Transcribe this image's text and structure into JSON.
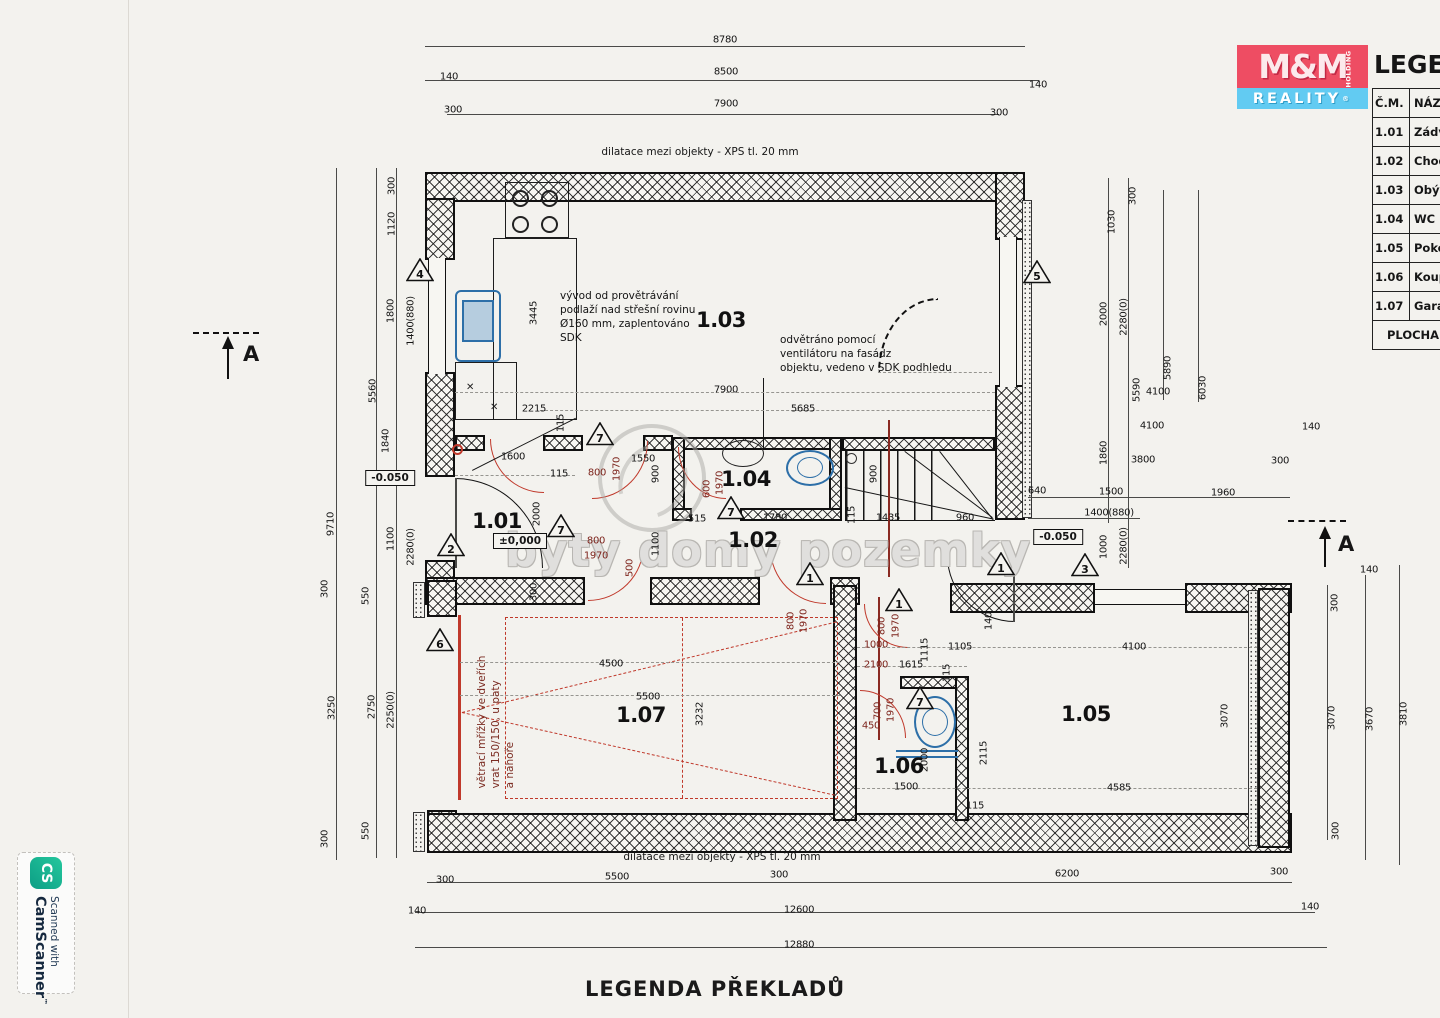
{
  "colors": {
    "accent_red": "#c0392b",
    "fixture_blue": "#2d6fa8",
    "brand_red": "#ee4d63",
    "brand_blue": "#62cbf2",
    "paper": "#f3f2ee"
  },
  "brand": {
    "mm": "M&M",
    "holding": "HOLDING",
    "reality": "REALITY",
    "reg": "®"
  },
  "legend": {
    "title": "LEGENDA",
    "col1": "Č.M.",
    "col2": "NÁZEV",
    "footer": "PLOCHA",
    "rows": [
      [
        "1.01",
        "Zádveří"
      ],
      [
        "1.02",
        "Chodba"
      ],
      [
        "1.03",
        "Obývací"
      ],
      [
        "1.04",
        "WC"
      ],
      [
        "1.05",
        "Pokoj"
      ],
      [
        "1.06",
        "Koupelna"
      ],
      [
        "1.07",
        "Garáž"
      ]
    ]
  },
  "camscanner": {
    "logo": "CS",
    "line1": "Scanned with",
    "line2": "CamScanner",
    "tm": "™"
  },
  "watermark": {
    "text": "byty domy pozemky"
  },
  "bottom_title": "LEGENDA PŘEKLADŮ",
  "top_note": "dilatace mezi objekty - XPS tl. 20 mm",
  "bottom_note": "dilatace mezi objekty - XPS tl. 20 mm",
  "section_markers": [
    {
      "label": "A"
    },
    {
      "label": "A"
    }
  ],
  "notes": [
    {
      "id": "note-vent-roof",
      "x": 560,
      "y": 290,
      "rot": 0,
      "color": "#131313",
      "lines": [
        "vývod od provětrávání",
        "podlaží nad střešní rovinu",
        "Ø160 mm, zaplentováno",
        "SDK"
      ]
    },
    {
      "id": "note-vent-fan",
      "x": 780,
      "y": 334,
      "rot": 0,
      "color": "#131313",
      "lines": [
        "odvětráno pomocí",
        "ventilátoru na fasádz",
        "objektu, vedeno v SDK podhledu"
      ]
    },
    {
      "id": "note-garage-grille",
      "x": 497,
      "y": 722,
      "rot": 1,
      "color": "#7a2a20",
      "lines": [
        "větrací mřížky ve dveřích",
        "vrat 150/150, u paty",
        "a nahoře"
      ]
    }
  ],
  "rooms": [
    [
      "1.01",
      497,
      521
    ],
    [
      "1.02",
      753,
      540
    ],
    [
      "1.03",
      721,
      320
    ],
    [
      "1.04",
      746,
      479
    ],
    [
      "1.05",
      1086,
      714
    ],
    [
      "1.06",
      899,
      766
    ],
    [
      "1.07",
      641,
      715
    ]
  ],
  "elevations": [
    [
      "±0,000",
      520,
      541
    ],
    [
      "-0.050",
      390,
      478
    ],
    [
      "-0.050",
      1058,
      537
    ]
  ],
  "triangles": [
    [
      4,
      420,
      272
    ],
    [
      5,
      1037,
      274
    ],
    [
      2,
      451,
      547
    ],
    [
      7,
      600,
      436
    ],
    [
      7,
      561,
      528
    ],
    [
      7,
      731,
      510
    ],
    [
      1,
      810,
      576
    ],
    [
      1,
      899,
      602
    ],
    [
      1,
      1001,
      566
    ],
    [
      3,
      1085,
      567
    ],
    [
      7,
      920,
      700
    ],
    [
      6,
      440,
      642
    ]
  ],
  "dims": [
    [
      "8780",
      725,
      40
    ],
    [
      "140",
      449,
      77
    ],
    [
      "8500",
      726,
      72
    ],
    [
      "140",
      1038,
      85
    ],
    [
      "300",
      453,
      110
    ],
    [
      "7900",
      726,
      104
    ],
    [
      "300",
      999,
      113
    ],
    [
      "9710",
      331,
      524,
      1
    ],
    [
      "5560",
      373,
      391,
      1
    ],
    [
      "300",
      392,
      186,
      1
    ],
    [
      "1120",
      392,
      224,
      1
    ],
    [
      "1800",
      391,
      311,
      1
    ],
    [
      "1400(880)",
      411,
      321,
      1
    ],
    [
      "1840",
      386,
      441,
      1
    ],
    [
      "1100",
      391,
      539,
      1
    ],
    [
      "2280(0)",
      411,
      547,
      1
    ],
    [
      "300",
      325,
      589,
      1
    ],
    [
      "550",
      366,
      596,
      1
    ],
    [
      "3250",
      332,
      708,
      1
    ],
    [
      "2750",
      372,
      707,
      1
    ],
    [
      "2250(0)",
      391,
      710,
      1
    ],
    [
      "550",
      366,
      831,
      1
    ],
    [
      "300",
      325,
      839,
      1
    ],
    [
      "140",
      417,
      911
    ],
    [
      "300",
      1133,
      196,
      1
    ],
    [
      "1030",
      1112,
      222,
      1
    ],
    [
      "2000",
      1104,
      314,
      1
    ],
    [
      "2280(0)",
      1124,
      317,
      1
    ],
    [
      "5590",
      1137,
      390,
      1
    ],
    [
      "5890",
      1168,
      368,
      1
    ],
    [
      "6030",
      1203,
      388,
      1
    ],
    [
      "4100",
      1158,
      392
    ],
    [
      "1860",
      1104,
      453,
      1
    ],
    [
      "4100",
      1152,
      426
    ],
    [
      "3800",
      1143,
      460
    ],
    [
      "140",
      1311,
      427
    ],
    [
      "300",
      1280,
      461
    ],
    [
      "640",
      1037,
      491
    ],
    [
      "1500",
      1111,
      492
    ],
    [
      "1960",
      1223,
      493
    ],
    [
      "1400(880)",
      1109,
      513
    ],
    [
      "1000",
      1104,
      547,
      1
    ],
    [
      "2280(0)",
      1124,
      546,
      1
    ],
    [
      "140",
      1369,
      570
    ],
    [
      "300",
      1335,
      603,
      1
    ],
    [
      "3070",
      1332,
      718,
      1
    ],
    [
      "3670",
      1370,
      719,
      1
    ],
    [
      "3810",
      1404,
      714,
      1
    ],
    [
      "300",
      1336,
      831,
      1
    ],
    [
      "300",
      445,
      880
    ],
    [
      "5500",
      617,
      877
    ],
    [
      "300",
      779,
      875
    ],
    [
      "12600",
      799,
      910
    ],
    [
      "12880",
      799,
      945
    ],
    [
      "6200",
      1067,
      874
    ],
    [
      "300",
      1279,
      872
    ],
    [
      "140",
      1310,
      907
    ],
    [
      "3445",
      534,
      313,
      1
    ],
    [
      "2215",
      534,
      409
    ],
    [
      "115",
      561,
      423,
      1
    ],
    [
      "1600",
      513,
      457
    ],
    [
      "115",
      559,
      474
    ],
    [
      "2000",
      537,
      514,
      1
    ],
    [
      "800",
      597,
      473,
      0,
      1
    ],
    [
      "1970",
      617,
      469,
      1,
      1
    ],
    [
      "1550",
      643,
      459
    ],
    [
      "900",
      656,
      474,
      1
    ],
    [
      "600",
      707,
      489,
      1,
      1
    ],
    [
      "1970",
      720,
      483,
      1,
      1
    ],
    [
      "7900",
      726,
      390
    ],
    [
      "5685",
      803,
      409
    ],
    [
      "515",
      697,
      519
    ],
    [
      "1780",
      775,
      518
    ],
    [
      "115",
      852,
      515,
      1
    ],
    [
      "1435",
      888,
      518
    ],
    [
      "960",
      965,
      518
    ],
    [
      "900",
      874,
      474,
      1
    ],
    [
      "800",
      596,
      541,
      0,
      1
    ],
    [
      "1970",
      596,
      556,
      0,
      1
    ],
    [
      "500",
      630,
      568,
      1,
      1
    ],
    [
      "1100",
      656,
      544,
      1
    ],
    [
      "300",
      534,
      592,
      1
    ],
    [
      "4500",
      611,
      664
    ],
    [
      "5500",
      648,
      697
    ],
    [
      "3232",
      700,
      714,
      1
    ],
    [
      "800",
      791,
      621,
      1,
      1
    ],
    [
      "1970",
      804,
      621,
      1,
      1
    ],
    [
      "800",
      882,
      626,
      1,
      1
    ],
    [
      "1970",
      896,
      626,
      1,
      1
    ],
    [
      "1000",
      876,
      645,
      0,
      1
    ],
    [
      "2100",
      876,
      665,
      0,
      1
    ],
    [
      "1615",
      911,
      665
    ],
    [
      "1115",
      925,
      650,
      1
    ],
    [
      "1105",
      960,
      647
    ],
    [
      "115",
      947,
      673,
      1
    ],
    [
      "140",
      989,
      621,
      1
    ],
    [
      "4100",
      1134,
      647
    ],
    [
      "450",
      871,
      726,
      0,
      1
    ],
    [
      "700",
      878,
      711,
      1,
      1
    ],
    [
      "1970",
      891,
      710,
      1,
      1
    ],
    [
      "2115",
      984,
      753,
      1
    ],
    [
      "2000",
      925,
      760,
      1
    ],
    [
      "1500",
      906,
      787
    ],
    [
      "115",
      975,
      806
    ],
    [
      "4585",
      1119,
      788
    ],
    [
      "3070",
      1225,
      716,
      1
    ]
  ],
  "lines": [
    [
      425,
      46,
      600,
      0,
      0
    ],
    [
      425,
      80,
      614,
      0,
      0
    ],
    [
      447,
      114,
      552,
      0,
      0
    ],
    [
      336,
      168,
      692,
      1,
      0
    ],
    [
      376,
      168,
      437,
      1,
      0
    ],
    [
      396,
      168,
      437,
      1,
      0
    ],
    [
      376,
      600,
      258,
      1,
      0
    ],
    [
      396,
      600,
      258,
      1,
      0
    ],
    [
      1108,
      178,
      345,
      1,
      0
    ],
    [
      1128,
      178,
      390,
      1,
      0
    ],
    [
      1163,
      190,
      210,
      1,
      0
    ],
    [
      1198,
      190,
      212,
      1,
      0
    ],
    [
      1028,
      497,
      262,
      0,
      0
    ],
    [
      1028,
      518,
      112,
      0,
      0
    ],
    [
      1327,
      585,
      255,
      1,
      0
    ],
    [
      1365,
      575,
      285,
      1,
      0
    ],
    [
      1399,
      565,
      300,
      1,
      0
    ],
    [
      427,
      882,
      865,
      0,
      0
    ],
    [
      415,
      912,
      900,
      0,
      0
    ],
    [
      415,
      947,
      912,
      0,
      0
    ],
    [
      455,
      392,
      540,
      0,
      1
    ],
    [
      540,
      410,
      455,
      0,
      1
    ],
    [
      857,
      647,
      400,
      0,
      1
    ],
    [
      857,
      666,
      110,
      0,
      1
    ],
    [
      857,
      788,
      400,
      0,
      1
    ],
    [
      455,
      475,
      120,
      0,
      1
    ],
    [
      460,
      662,
      380,
      0,
      1
    ],
    [
      460,
      695,
      380,
      0,
      1
    ],
    [
      878,
      372,
      114,
      0,
      1
    ]
  ]
}
